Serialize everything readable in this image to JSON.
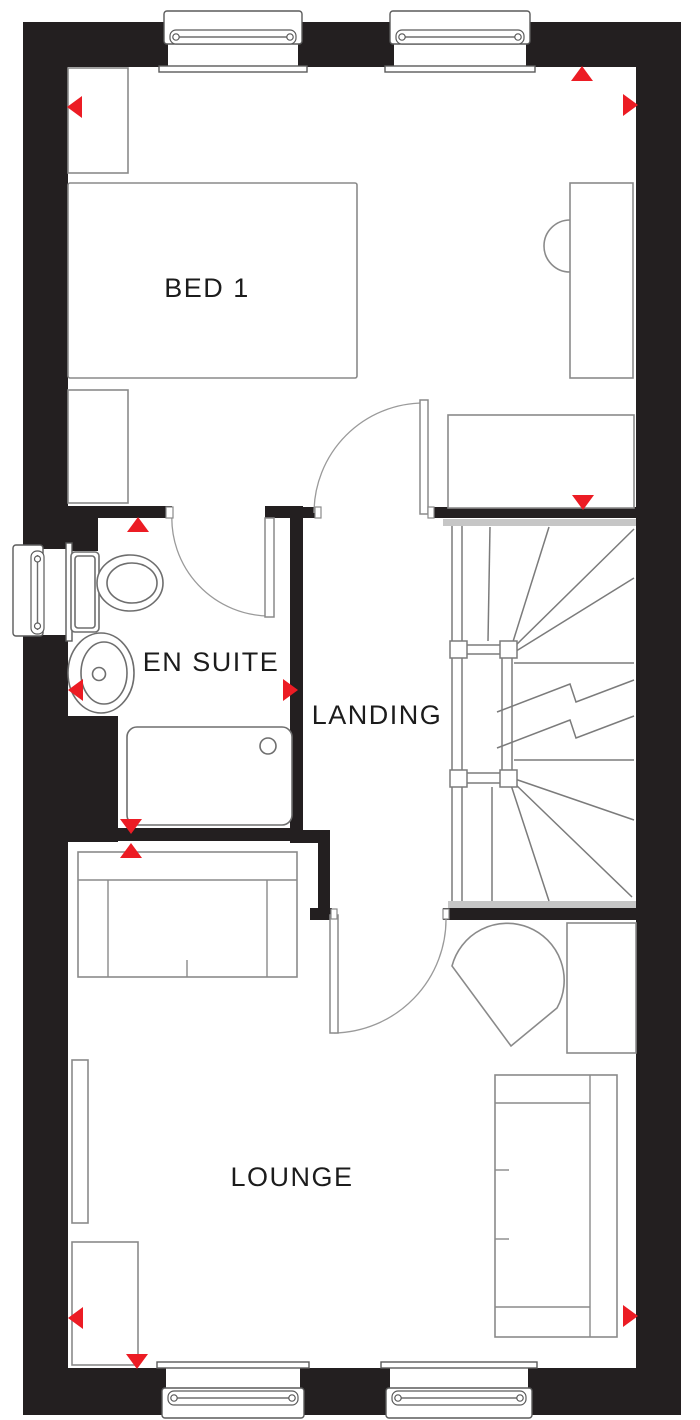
{
  "plan": {
    "type": "floorplan",
    "floor_description": "First floor plan with BED 1, EN SUITE, LANDING (stairs) and LOUNGE",
    "rooms": {
      "bed1": {
        "label": "BED 1"
      },
      "ensuite": {
        "label": "EN SUITE"
      },
      "landing": {
        "label": "LANDING"
      },
      "lounge": {
        "label": "LOUNGE"
      }
    },
    "colors": {
      "wall": "#231f20",
      "furniture_line": "#8a8a8a",
      "fixture_line": "#6e6e6e",
      "stair_line": "#7b7b7b",
      "nosing": "#c6c6c6",
      "arrow": "#ec1c24",
      "label_text": "#1c1c1c"
    },
    "arrows": [
      {
        "x": 75,
        "y": 107,
        "dir": "left"
      },
      {
        "x": 582,
        "y": 74,
        "dir": "up"
      },
      {
        "x": 630,
        "y": 105,
        "dir": "right"
      },
      {
        "x": 583,
        "y": 502,
        "dir": "down"
      },
      {
        "x": 138,
        "y": 525,
        "dir": "up"
      },
      {
        "x": 76,
        "y": 690,
        "dir": "left"
      },
      {
        "x": 290,
        "y": 690,
        "dir": "right"
      },
      {
        "x": 131,
        "y": 826,
        "dir": "down"
      },
      {
        "x": 131,
        "y": 851,
        "dir": "up"
      },
      {
        "x": 76,
        "y": 1318,
        "dir": "left"
      },
      {
        "x": 137,
        "y": 1361,
        "dir": "down"
      },
      {
        "x": 630,
        "y": 1316,
        "dir": "right"
      }
    ]
  }
}
